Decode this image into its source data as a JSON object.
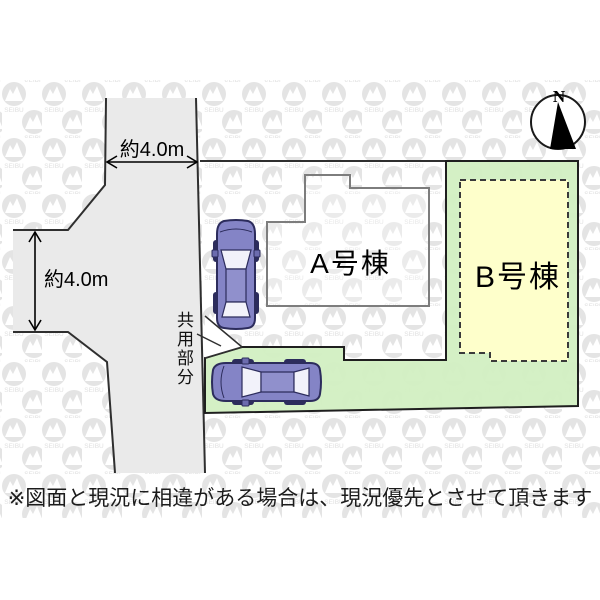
{
  "diagram": {
    "title_none": "",
    "road": {
      "dim_top_label": "約4.0m",
      "dim_left_label": "約4.0m"
    },
    "buildings": {
      "a_label": "A号棟",
      "b_label": "B号棟"
    },
    "shared_area_label": "共用部分",
    "compass": {
      "north_label": "N"
    },
    "watermark_text": "SEIBU",
    "disclaimer": "※図面と現況に相違がある場合は、現況優先とさせて頂きます"
  },
  "colors": {
    "road_fill": "#eaeaea",
    "plot_green": "#d2efc2",
    "building_b_yellow": "#ffffcb",
    "building_a_fill": "none",
    "line_dark": "#2f2f2f",
    "building_a_border": "#7d7d7d",
    "car_body": "#8484c6",
    "car_outline": "#2c2c5c",
    "car_glass": "#f2f2fa",
    "watermark_gray": "#e4e4e4",
    "wedge_white": "#ffffff"
  }
}
